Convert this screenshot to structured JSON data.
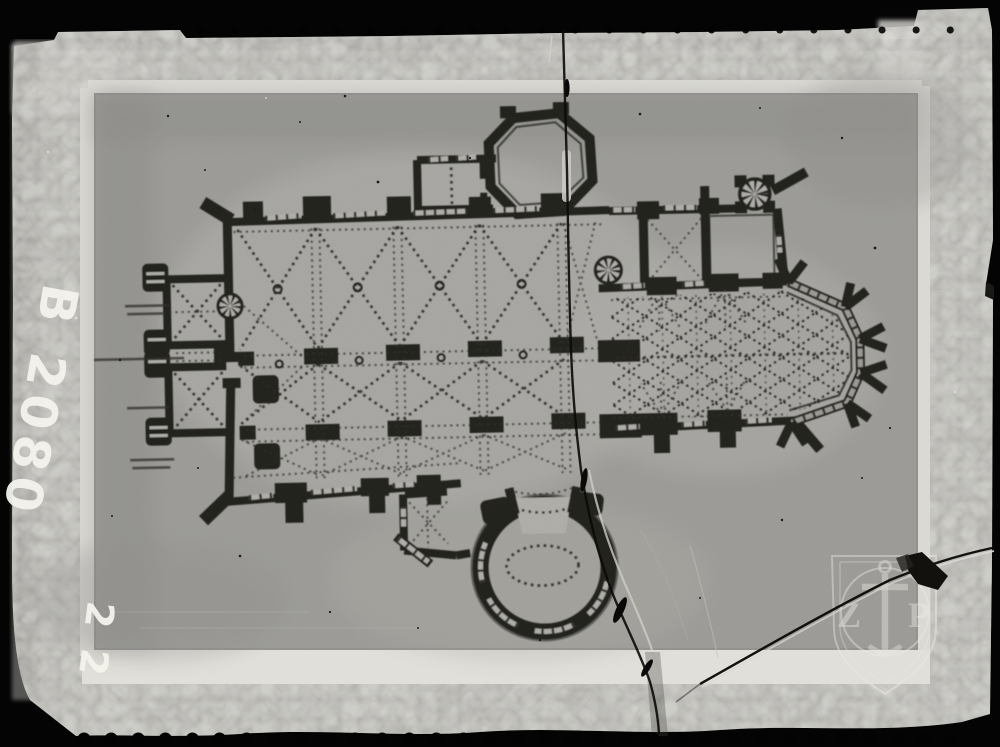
{
  "plate": {
    "handwritten_number": "B 2080",
    "handwritten_number_partial": "2 2"
  },
  "watermark": {
    "letter_left": "Z",
    "letter_right": "P"
  },
  "colors": {
    "surround": "#040404",
    "film_border": "#c1c0bb",
    "frame_white": "#f0efe9",
    "photo_background": "#b4b3af",
    "plan_ink": "#23211d",
    "chalk": "#f4f3ec"
  }
}
